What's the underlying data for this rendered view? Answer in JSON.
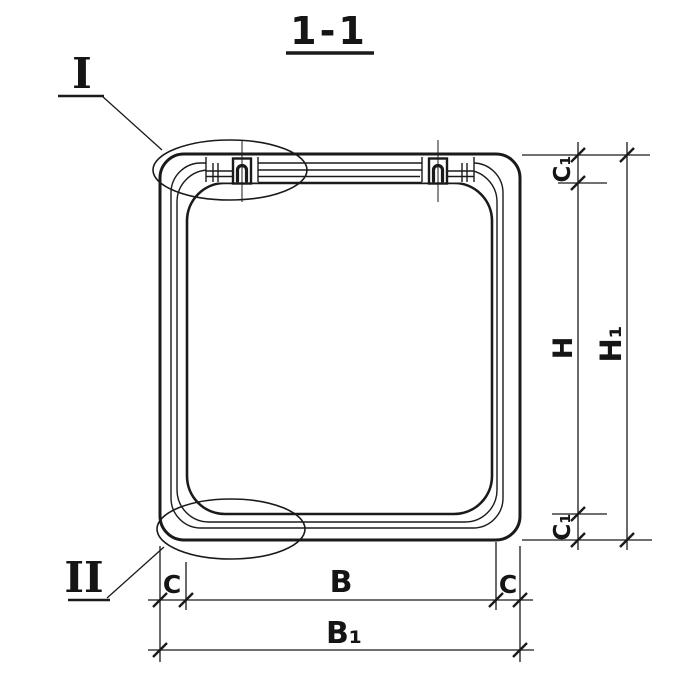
{
  "title": {
    "text": "1-1"
  },
  "callouts": {
    "detail_top": "I",
    "detail_bottom": "II"
  },
  "dimensions": {
    "bottom": {
      "c_left": "C",
      "b": "B",
      "c_right": "C",
      "b1": "B₁"
    },
    "right": {
      "c1_top": "C₁",
      "h": "H",
      "h1": "H₁",
      "c1_bottom": "C₁"
    }
  },
  "colors": {
    "ink": "#1a1a1a",
    "paper": "#ffffff"
  }
}
